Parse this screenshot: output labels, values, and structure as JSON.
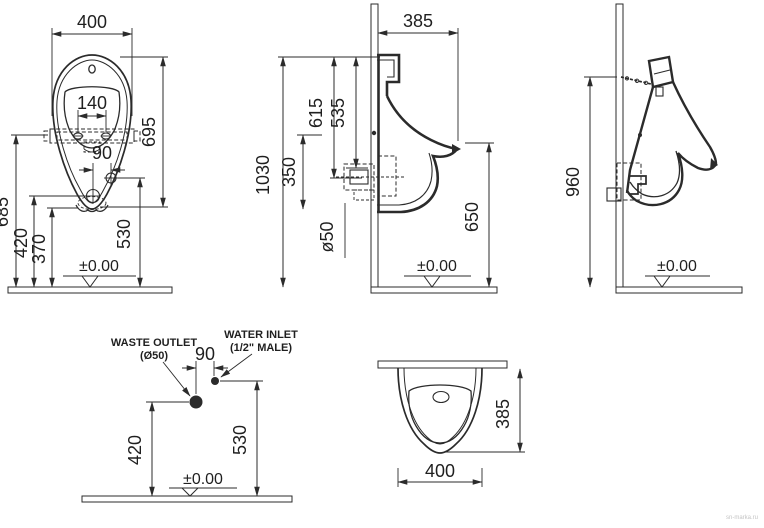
{
  "colors": {
    "line": "#2b2b2b",
    "text": "#1f1f1f",
    "hatch_fill": "#d8d8d8",
    "hatch_line": "#8a8a8a",
    "watermark": "#c4c4c4"
  },
  "front_view": {
    "dim_width": "400",
    "dim_height": "695",
    "dim_bolt_spacing": "140",
    "dim_inlet_offset": "90",
    "dim_bracket_height": "685",
    "dim_outlet_height": "420",
    "dim_bottom_height": "370",
    "dim_inlet_height": "530",
    "datum": "±0.00"
  },
  "side_view": {
    "dim_depth": "385",
    "dim_overall_height": "1030",
    "dim_top_to_outlet": "615",
    "dim_top_to_inlet": "535",
    "dim_mid_span": "350",
    "dim_outlet_diameter": "ø50",
    "dim_rim_height": "650",
    "datum": "±0.00"
  },
  "perspective_view": {
    "dim_hanger_height": "960",
    "datum": "±0.00"
  },
  "connection_view": {
    "waste_outlet_label_line1": "WASTE OUTLET",
    "waste_outlet_label_line2": "(Ø50)",
    "water_inlet_label_line1": "WATER INLET",
    "water_inlet_label_line2": "(1/2\" MALE)",
    "dim_offset": "90",
    "dim_outlet_height": "420",
    "dim_inlet_height": "530",
    "datum": "±0.00"
  },
  "plan_view": {
    "dim_depth": "385",
    "dim_width": "400"
  },
  "watermark": "sn-marka.ru"
}
